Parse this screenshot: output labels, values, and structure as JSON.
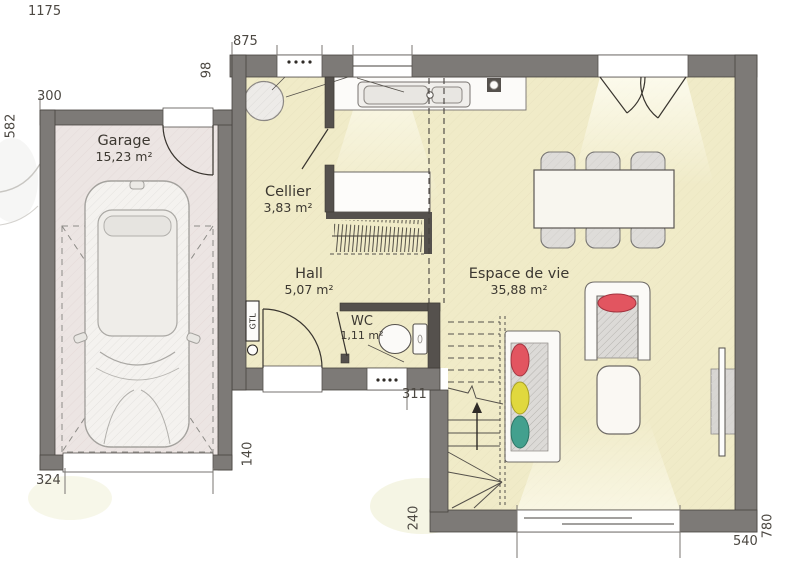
{
  "plan": {
    "rooms": {
      "garage": {
        "name": "Garage",
        "area": "15,23 m²"
      },
      "cellier": {
        "name": "Cellier",
        "area": "3,83 m²"
      },
      "hall": {
        "name": "Hall",
        "area": "5,07 m²"
      },
      "wc": {
        "name": "WC",
        "area": "1,11 m²"
      },
      "living": {
        "name": "Espace de vie",
        "area": "35,88 m²"
      }
    },
    "dimensions": {
      "total_width": "1175",
      "front_width": "875",
      "front_offset": "98",
      "garage_width": "300",
      "garage_depth": "582",
      "garage_door_width": "324",
      "entry_depth": "140",
      "entry_width": "311",
      "rear_offset": "240",
      "bay_width": "540",
      "side_depth": "780"
    },
    "annotations": {
      "gtl": "GTL"
    },
    "colors": {
      "wall": "#7d7a77",
      "partition": "#55514d",
      "floor_living": "#f0ebc8",
      "floor_garage": "#ece5e3",
      "pillow_red": "#e25560",
      "pillow_yellow": "#e0d83e",
      "pillow_teal": "#43a08e"
    }
  }
}
